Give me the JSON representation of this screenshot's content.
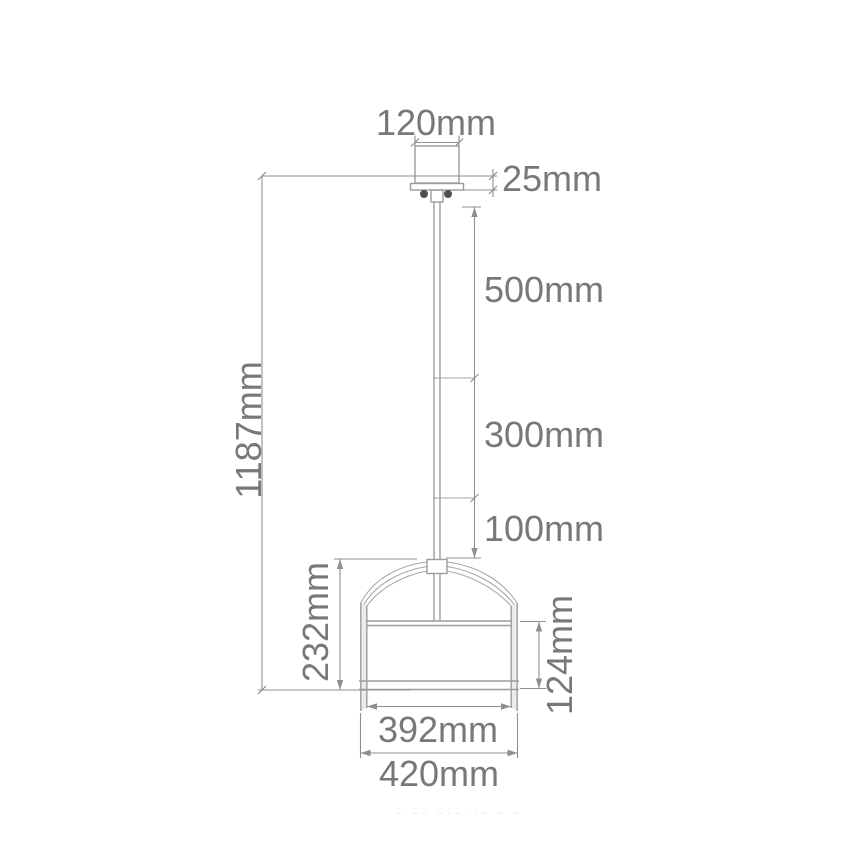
{
  "figure": {
    "type": "technical-dimension-drawing",
    "subject": "pendant-lamp",
    "unit": "mm",
    "labels": {
      "canopy_width": "120mm",
      "canopy_thickness": "25mm",
      "rod_upper_segment": "500mm",
      "rod_middle_segment": "300mm",
      "rod_lower_segment": "100mm",
      "overall_height": "1187mm",
      "shade_total_height": "232mm",
      "drum_height": "124mm",
      "drum_inner_width": "392mm",
      "drum_outer_width": "420mm"
    },
    "artifact_fragment": "- -- -·-··- - -",
    "colors": {
      "background": "#ffffff",
      "fixture_line": "#9c9c9c",
      "dimension_line": "#8f8f8f",
      "label_text": "#787878",
      "screw_fill": "#4f4f4f"
    }
  }
}
